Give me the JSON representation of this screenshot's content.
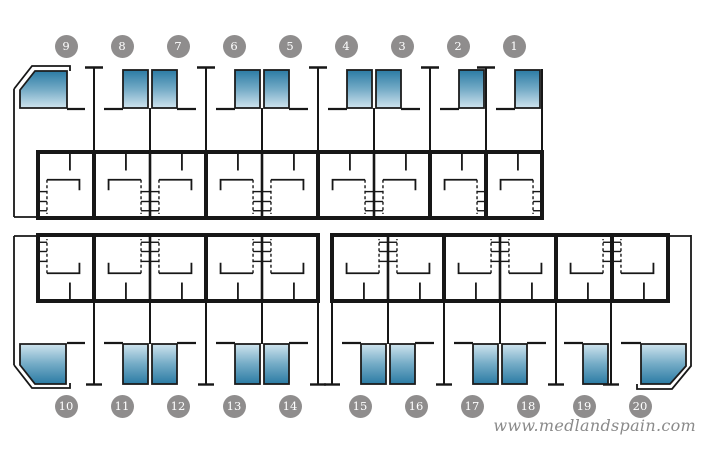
{
  "watermark": {
    "text": "www.medlandspain.com"
  },
  "colors": {
    "background": "#ffffff",
    "wall": "#171717",
    "pool_border": "#1c1c1c",
    "pool_deep": "#2b7ba4",
    "pool_mid": "#74abc6",
    "pool_shallow": "#cfe4ee",
    "badge_bg": "#8f8d8d",
    "badge_text": "#ffffff",
    "watermark_text": "#8a8a8a"
  },
  "blocks": [
    {
      "name": "top-row",
      "pools_facing": "up",
      "units": [
        {
          "number": "9",
          "pool": "corner-left",
          "stairs": "left"
        },
        {
          "number": "8",
          "pool": "pair",
          "stairs": "right"
        },
        {
          "number": "7",
          "pool": "pair",
          "stairs": "left"
        },
        {
          "number": "6",
          "pool": "pair",
          "stairs": "right"
        },
        {
          "number": "5",
          "pool": "pair",
          "stairs": "left"
        },
        {
          "number": "4",
          "pool": "pair",
          "stairs": "right"
        },
        {
          "number": "3",
          "pool": "pair",
          "stairs": "left"
        },
        {
          "number": "2",
          "pool": "single",
          "stairs": "right"
        },
        {
          "number": "1",
          "pool": "single",
          "stairs": "right"
        }
      ]
    },
    {
      "name": "bottom-left-row",
      "pools_facing": "down",
      "units": [
        {
          "number": "10",
          "pool": "corner-left",
          "stairs": "left"
        },
        {
          "number": "11",
          "pool": "pair",
          "stairs": "right"
        },
        {
          "number": "12",
          "pool": "pair",
          "stairs": "left"
        },
        {
          "number": "13",
          "pool": "pair",
          "stairs": "right"
        },
        {
          "number": "14",
          "pool": "pair",
          "stairs": "left"
        }
      ]
    },
    {
      "name": "bottom-right-row",
      "pools_facing": "down",
      "units": [
        {
          "number": "15",
          "pool": "pair",
          "stairs": "right"
        },
        {
          "number": "16",
          "pool": "pair",
          "stairs": "left"
        },
        {
          "number": "17",
          "pool": "pair",
          "stairs": "right"
        },
        {
          "number": "18",
          "pool": "pair",
          "stairs": "left"
        },
        {
          "number": "19",
          "pool": "single",
          "stairs": "right"
        },
        {
          "number": "20",
          "pool": "corner-right",
          "stairs": "left"
        }
      ]
    }
  ]
}
